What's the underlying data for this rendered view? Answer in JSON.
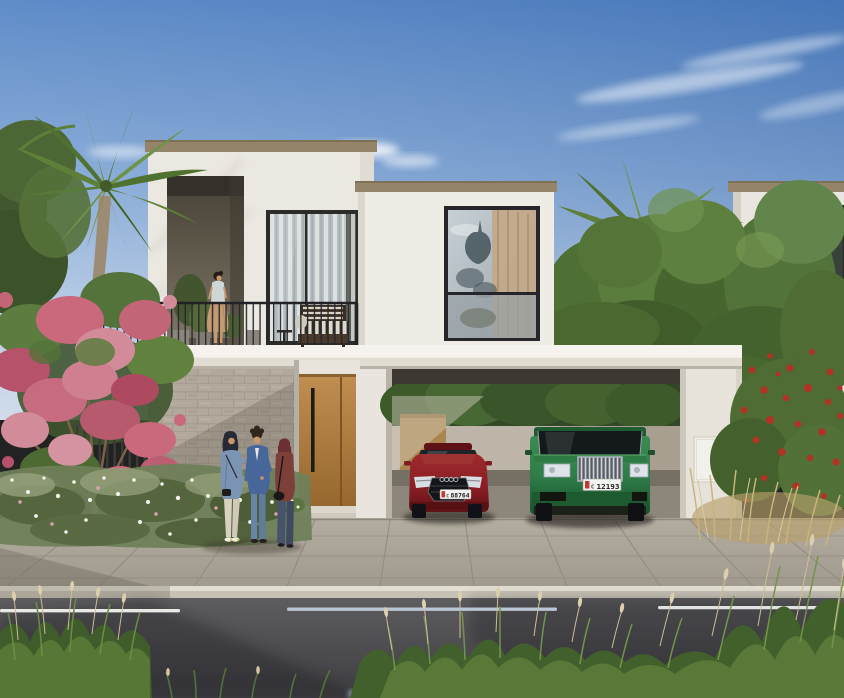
{
  "scene": {
    "description": "Exterior render of a modern two-storey white villa with balcony, carport, palm trees and street",
    "time_of_day": "day",
    "sky": "clear blue with wispy clouds"
  },
  "palette": {
    "sky-top": "#4d7fc2",
    "sky-horizon": "#ccd9e9",
    "villa-wall": "#ebe8e1",
    "roof-trim": "#94846a",
    "niche-wall": "#6e665a",
    "slab-white": "#f1eee7",
    "stone-wall": "#b2a99c",
    "door-wood": "#b5824a",
    "railing-dark": "#26262a",
    "glass-tint": "#b6c0c4",
    "curtain-tan": "#c3a887",
    "pillar-white": "#e7e3db",
    "pavement": "#aaa296",
    "curb": "#c6c1b5",
    "road": "#4e4e52",
    "lane-dash": "#e9eae6",
    "grass-green": "#5d7c3a",
    "palm-green": "#5d8038",
    "pink-blossom": "#c9697b",
    "red-blossom": "#b33226",
    "dry-grass": "#c9b47c",
    "car-red": "#8c1f26",
    "car-green": "#2f7e49",
    "plate-white": "#f2f2f0"
  },
  "vehicles": {
    "red_sedan": {
      "type": "sedan",
      "color_name": "red",
      "plate_code": "C",
      "plate_number": "88764"
    },
    "green_suv": {
      "type": "suv",
      "color_name": "green",
      "plate_code": "C",
      "plate_number": "12193"
    }
  },
  "people": {
    "balcony_woman": {
      "count": 1,
      "description": "woman standing on first-floor balcony"
    },
    "street_group": {
      "count": 3,
      "description": "three people talking near the entrance door"
    }
  },
  "road_markings": {
    "center_line": "dashed white lane divider"
  }
}
